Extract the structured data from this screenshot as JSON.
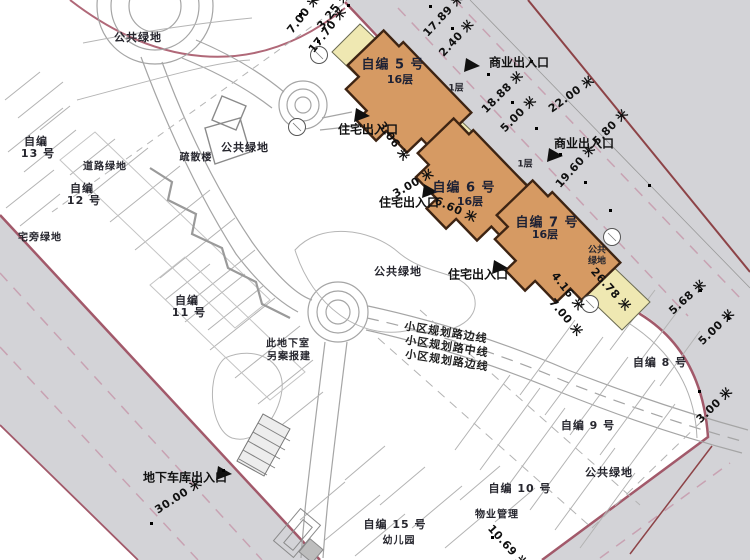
{
  "towers": [
    {
      "name": "自编 5 号",
      "floors": "16层"
    },
    {
      "name": "自编 6 号",
      "floors": "16层"
    },
    {
      "name": "自编 7 号",
      "floors": "16层"
    }
  ],
  "podium_floor_label": "1层",
  "entrances": {
    "residential": "住宅出入口",
    "commercial": "商业出入口",
    "garage": "地下车库出入口"
  },
  "existing": {
    "b8": "自编 8 号",
    "b9": "自编 9 号",
    "b10": "自编 10 号",
    "b11a": "自编",
    "b11b": "11 号",
    "b12a": "自编",
    "b12b": "12 号",
    "b13a": "自编",
    "b13b": "13 号",
    "b15": "自编 15 号",
    "kindergarten": "幼儿园",
    "property_mgmt": "物业管理",
    "evac_stair": "疏散楼"
  },
  "green": {
    "public": "公共绿地",
    "public_2l_a": "公共",
    "public_2l_b": "绿地",
    "road_green": "道路绿地",
    "house_green": "宅旁绿地"
  },
  "notes": {
    "basement_a": "此地下室",
    "basement_b": "另案报建"
  },
  "road_marks": {
    "edge": "小区规划路边线",
    "center": "小区规划路中线"
  },
  "dims": [
    "17.89 米",
    "2.40 米",
    "17.70 米",
    "7.00 米",
    "3.25 米",
    "18.88 米",
    "5.00 米",
    "22.00 米",
    "5.80 米",
    "19.60 米",
    "3.06 米",
    "3.00 米",
    "6.60 米",
    "4.16 米",
    "7.00 米",
    "26.78 米",
    "5.68 米",
    "5.00 米",
    "3.00 米",
    "30.00 米",
    "10.69 米"
  ],
  "colors": {
    "tower_fill": "#d69a63",
    "tower_border": "#3d2413",
    "podium_fill": "#efe8b2",
    "road_fill": "#d3d3d7",
    "boundary_line": "#a2596a",
    "outer_boundary": "#8d4347",
    "dash_pink": "#c8a2b2"
  }
}
